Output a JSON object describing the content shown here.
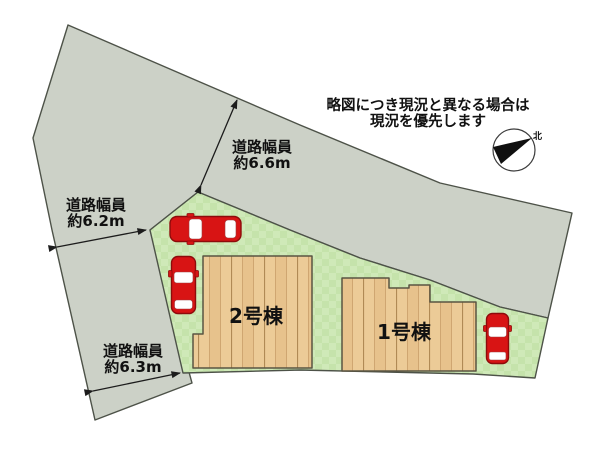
{
  "disclaimer": {
    "line1": "略図につき現況と異なる場合は",
    "line2": "現況を優先します"
  },
  "roads": [
    {
      "name": "north-road",
      "label_line1": "道路幅員",
      "label_line2": "約6.6m"
    },
    {
      "name": "west-upper-road",
      "label_line1": "道路幅員",
      "label_line2": "約6.2m"
    },
    {
      "name": "west-lower-road",
      "label_line1": "道路幅員",
      "label_line2": "約6.3m"
    }
  ],
  "buildings": [
    {
      "label": "2号棟"
    },
    {
      "label": "1号棟"
    }
  ],
  "compass": {
    "north_label": "北"
  },
  "colors": {
    "background": "#ffffff",
    "road": "#ccd1c7",
    "grass_light": "#cfe9b8",
    "grass_dark": "#c5e3ab",
    "wood_base": "#eccb97",
    "wood_alt": "#e7c28c",
    "car_red": "#d81414",
    "window_white": "#ffffff"
  }
}
